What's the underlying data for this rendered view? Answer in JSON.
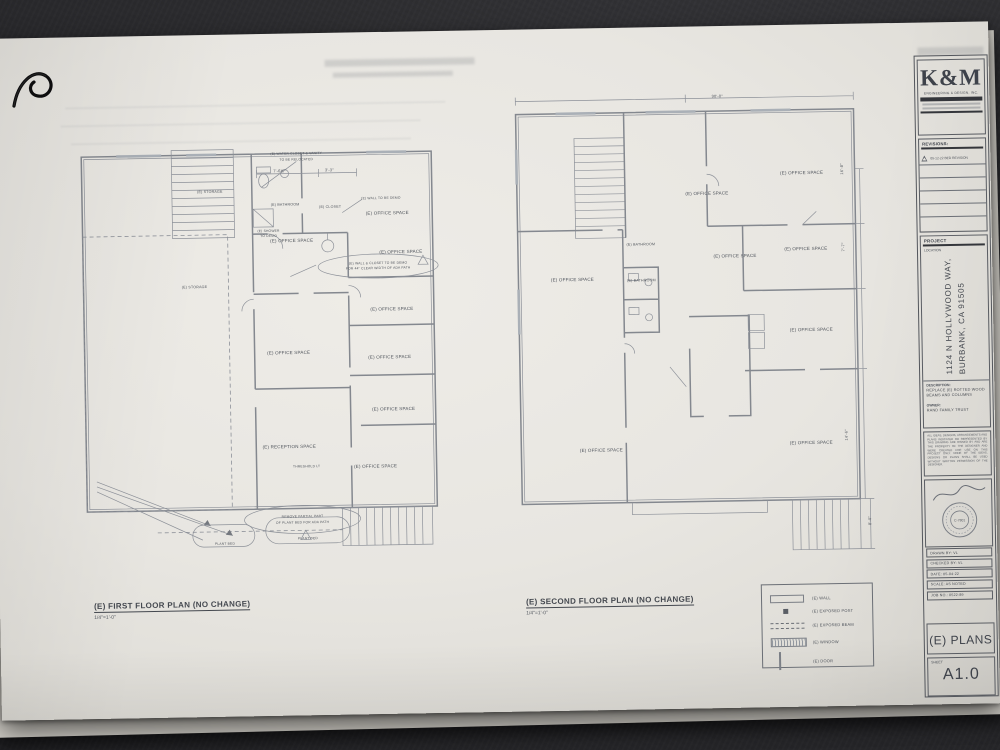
{
  "plans": {
    "first": {
      "title": "(E) FIRST FLOOR PLAN (NO CHANGE)",
      "scale": "1/4\"=1'-0\"",
      "wc_note_l1": "(E) WATER CLOSET & VANITY",
      "wc_note_l2": "TO BE RELOCATED",
      "dim_a": "7'-6½\"",
      "dim_b": "3'-3\"",
      "storage_top": "(E) STORAGE",
      "storage_mid": "(E) STORAGE",
      "bathroom": "(E) BATHROOM",
      "closet": "(E) CLOSET",
      "wall_demo": "(E) WALL TO BE DEMO",
      "shower_l1": "(E) SHOWER",
      "shower_l2": "TO DEMO",
      "office": "(E) OFFICE SPACE",
      "reception": "(E) RECEPTION SPACE",
      "threshold": "THRESHOLD LT",
      "ada_note_l1": "(E) WALL & CLOSET TO BE DEMO",
      "ada_note_l2": "FOR 44\" CLEAR WIDTH OF ADA PATH",
      "plant_note_l1": "REMOVE PARTIAL PART",
      "plant_note_l2": "OF PLANT BED FOR ADA PATH",
      "plant_bed": "PLANT BED"
    },
    "second": {
      "title": "(E) SECOND FLOOR PLAN (NO CHANGE)",
      "scale": "1/4\"=1'-0\"",
      "dim_top": "90'-0\"",
      "office": "(E) OFFICE SPACE",
      "bathroom": "(E) BATHROOM",
      "dim_r1": "16'-8\"",
      "dim_r2": "7'-7\"",
      "dim_r3": "14'-6\"",
      "dim_r4": "8'-0\""
    }
  },
  "legend": {
    "wall": "(E) WALL",
    "post": "(E) EXPOSED POST",
    "beam": "(E) EXPOSED BEAM",
    "window": "(E) WINDOW",
    "door": "(E) DOOR"
  },
  "titleblock": {
    "logo": "K&M",
    "firm": "ENGINEERING & DESIGN, INC.",
    "revisions_label": "REVISIONS:",
    "revision_1": "05-12-22 BED REVISION",
    "project_label": "PROJECT",
    "location_label": "LOCATION",
    "address_l1": "1124 N HOLLYWOOD WAY,",
    "address_l2": "BURBANK, CA 91505",
    "description_label": "DESCRIPTION:",
    "description": "REPLACE (E) ROTTED WOOD BEAMS AND COLUMNS",
    "owner_label": "OWNER:",
    "owner": "RAND FAMILY TRUST",
    "disclaimer": "ALL IDEAS, DESIGNS, ARRANGEMENTS AND PLANS INDICATED OR REPRESENTED BY THIS DRAWING ARE OWNED BY AND ARE THE PROPERTY OF THE DESIGNER AND WERE CREATED FOR USE ON THIS PROJECT ONLY. NONE OF THE IDEAS, DESIGNS OR PLANS SHALL BE USED WITHOUT WRITTEN PERMISSION OF THE DESIGNER.",
    "seal_no": "C-7801",
    "drawn_by": "DRAWN BY: VL",
    "checked_by": "CHECKED BY: VL",
    "date": "DATE: 05-04-22",
    "scale_row": "SCALE: AS NOTED",
    "job_no": "JOB NO.: 0522-89",
    "sheet_title": "(E) PLANS",
    "sheet_label": "SHEET",
    "sheet_number": "A1.0"
  }
}
